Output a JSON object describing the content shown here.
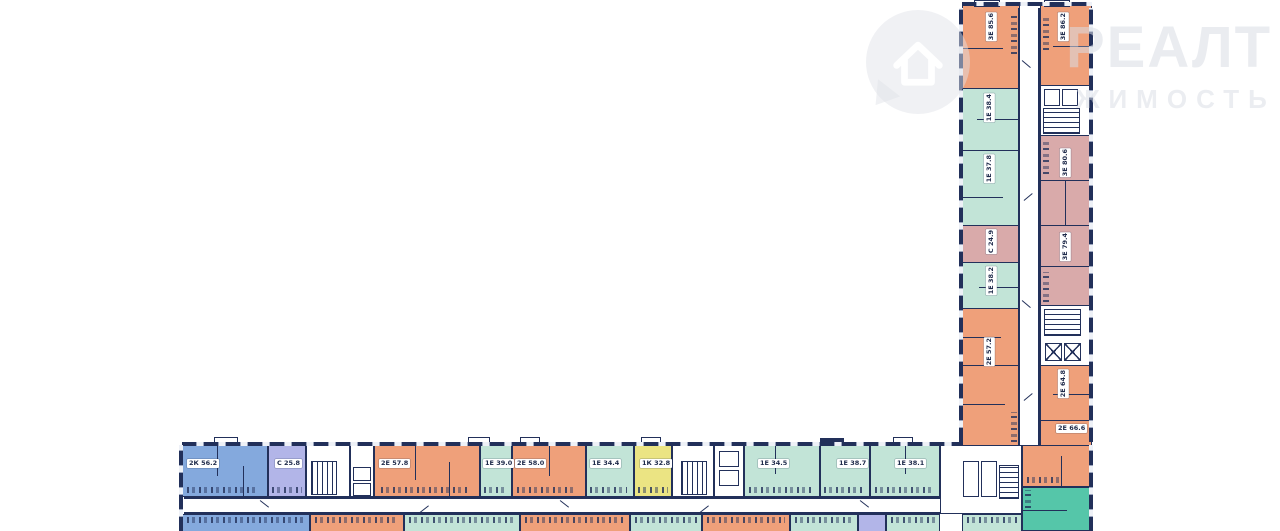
{
  "watermark": {
    "brand": "РЕАЛТ",
    "tagline": "ЖИМОСТЬ",
    "logo": "house-pin-icon",
    "color": "#ececec"
  },
  "palette": {
    "wall": "#22305a",
    "orange": "#efa07a",
    "teal": "#c2e4d7",
    "green": "#55c6a9",
    "blue": "#84a9dd",
    "purple": "#b2b5e8",
    "yellow": "#ebe483",
    "pink": "#d9aaaa",
    "corridor": "#ffffff"
  },
  "bottom_wing": {
    "apartments": [
      {
        "label": "2К 56.2",
        "color": "blue"
      },
      {
        "label": "С 25.8",
        "color": "purple"
      },
      {
        "label": "2Е 57.8",
        "color": "orange"
      },
      {
        "label": "1Е 39.0",
        "color": "teal"
      },
      {
        "label": "2Е 58.0",
        "color": "orange"
      },
      {
        "label": "1Е 34.4",
        "color": "teal"
      },
      {
        "label": "1К 32.8",
        "color": "yellow"
      },
      {
        "label": "1Е 34.5",
        "color": "teal"
      },
      {
        "label": "1Е 38.7",
        "color": "teal"
      },
      {
        "label": "1Е 38.1",
        "color": "teal"
      }
    ]
  },
  "vertical_wing": {
    "apartments": [
      {
        "label": "3Е 85.6",
        "color": "orange"
      },
      {
        "label": "3Е 86.2",
        "color": "orange"
      },
      {
        "label": "1Е 38.4",
        "color": "teal"
      },
      {
        "label": "1Е 37.8",
        "color": "teal"
      },
      {
        "label": "С 24.9",
        "color": "pink"
      },
      {
        "label": "1Е 38.2",
        "color": "teal"
      },
      {
        "label": "3Е 80.6",
        "color": "pink"
      },
      {
        "label": "3Е 79.4",
        "color": "pink"
      },
      {
        "label": "2Е 57.2",
        "color": "orange"
      },
      {
        "label": "2Е 64.8",
        "color": "orange"
      },
      {
        "label": "2Е 66.6",
        "color": "orange"
      }
    ]
  }
}
